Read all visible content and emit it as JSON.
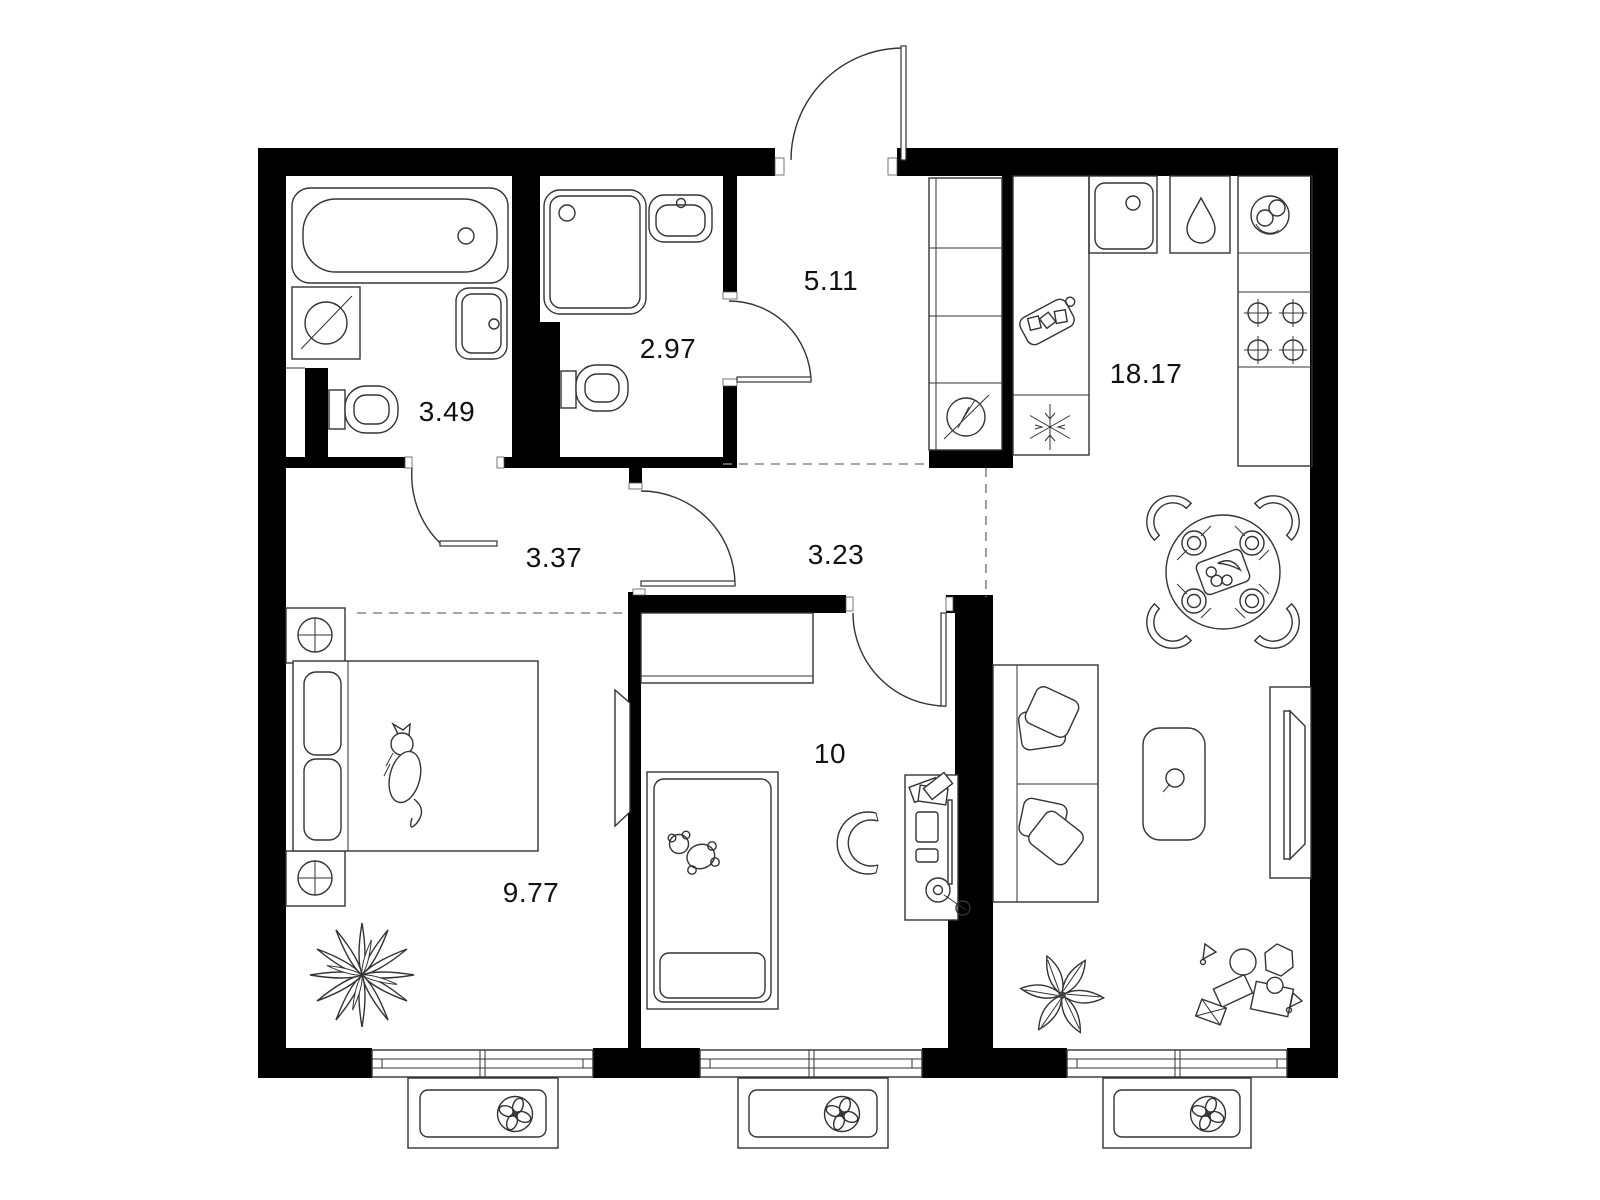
{
  "title": "Apartment floor plan (2-room flat)",
  "colors": {
    "background": "#ffffff",
    "walls": "#000000",
    "furniture_line": "#333333",
    "zone_dashed_line": "#888888",
    "label_text": "#111111"
  },
  "rooms": [
    {
      "name": "bathroom",
      "area_label": "3.49"
    },
    {
      "name": "shower-room",
      "area_label": "2.97"
    },
    {
      "name": "entrance-hall",
      "area_label": "5.11"
    },
    {
      "name": "corridor",
      "area_label": "3.37"
    },
    {
      "name": "inner-hall",
      "area_label": "3.23"
    },
    {
      "name": "kitchen-living-room",
      "area_label": "18.17"
    },
    {
      "name": "bedroom",
      "area_label": "9.77"
    },
    {
      "name": "children-room",
      "area_label": "10"
    }
  ],
  "icons": [
    "bathtub-icon",
    "washing-machine-icon",
    "toilet-icon",
    "hand-basin-icon",
    "shower-icon",
    "electrical-panel-icon",
    "wardrobe-shelves-icon",
    "freezer-snowflake-icon",
    "cutting-board-icon",
    "kitchen-sink-icon",
    "water-drop-icon",
    "dishes-icon",
    "stove-burners-icon",
    "dining-table-icon",
    "chair-icon",
    "sofa-icon",
    "coffee-table-icon",
    "tv-console-icon",
    "double-bed-icon",
    "cat-icon",
    "nightstand-lamp-icon",
    "mirror-icon",
    "plant-icon",
    "single-bed-icon",
    "teddy-bear-icon",
    "desk-icon",
    "desk-chair-icon",
    "desk-lamp-icon",
    "monitor-icon",
    "books-icon",
    "toys-icon",
    "window-icon",
    "ventilation-fan-icon",
    "door-swing-icon"
  ]
}
